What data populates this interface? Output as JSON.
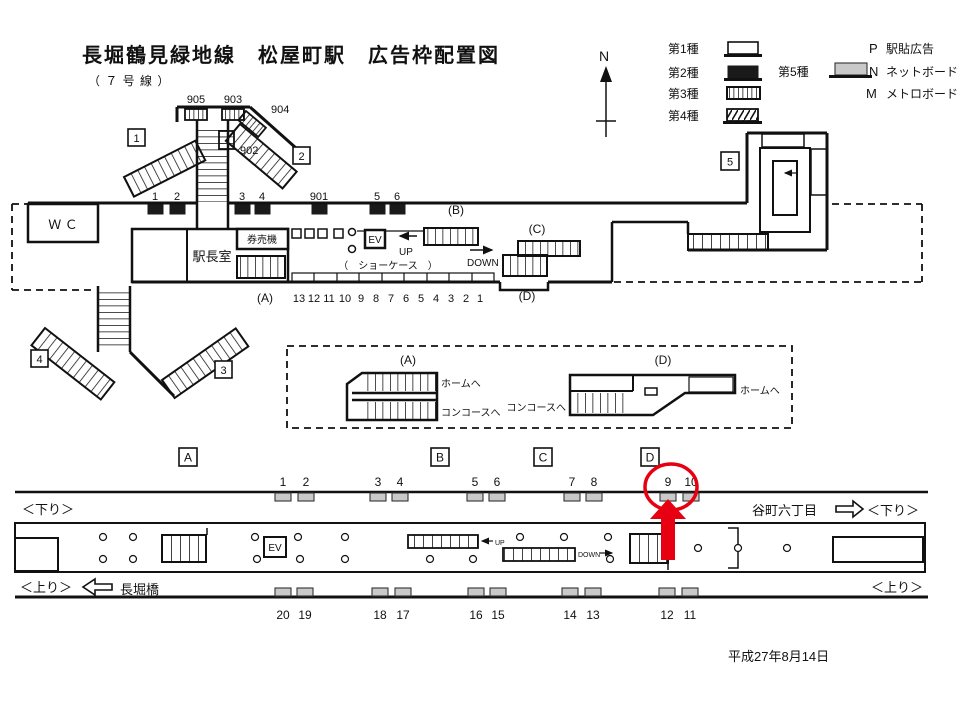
{
  "title": "長堀鶴見緑地線　松屋町駅　広告枠配置図",
  "subtitle": "（ ７ 号 線 ）",
  "date": "平成27年8月14日",
  "compass_label": "N",
  "legend": {
    "type1": "第1種",
    "type2": "第2種",
    "type3": "第3種",
    "type4": "第4種",
    "type5": "第5種",
    "p_key": "P",
    "p_label": "駅貼広告",
    "n_key": "N",
    "n_label": "ネットボード",
    "m_key": "M",
    "m_label": "メトロボード"
  },
  "concourse": {
    "wc": "Ｗ Ｃ",
    "office": "駅長室",
    "ticket_machines": "券売機",
    "showcase": "（　ショーケース　）",
    "ev": "EV",
    "up": "UP",
    "down": "DOWN",
    "exit_numbers": [
      "1",
      "2",
      "3",
      "4",
      "5"
    ],
    "upper_wall_ads": [
      "1",
      "2",
      "3",
      "4",
      "901",
      "5",
      "6"
    ],
    "street_ads": [
      "905",
      "903",
      "904",
      "902"
    ],
    "showcase_numbers": [
      "13",
      "12",
      "11",
      "10",
      "9",
      "8",
      "7",
      "6",
      "5",
      "4",
      "3",
      "2",
      "1"
    ],
    "area_a": "(A)",
    "area_b": "(B)",
    "area_c": "(C)",
    "area_d": "(D)"
  },
  "stair_details": {
    "a_label": "(A)",
    "d_label": "(D)",
    "a_to_platform": "ホームへ",
    "a_to_concourse": "コンコースへ",
    "d_to_platform": "ホームへ",
    "d_to_concourse": "コンコースへ"
  },
  "platform": {
    "section_labels": [
      "A",
      "B",
      "C",
      "D"
    ],
    "top_numbers": [
      "1",
      "2",
      "3",
      "4",
      "5",
      "6",
      "7",
      "8",
      "9",
      "10"
    ],
    "bottom_numbers": [
      "20",
      "19",
      "18",
      "17",
      "16",
      "15",
      "14",
      "13",
      "12",
      "11"
    ],
    "down_label_left": "＜下り＞",
    "down_label_right": "＜下り＞",
    "up_label_left": "＜上り＞",
    "up_label_right": "＜上り＞",
    "station_right": "谷町六丁目",
    "station_left": "長堀橋",
    "ev": "EV",
    "up": "UP",
    "down": "DOWN",
    "highlight_number": "9"
  },
  "colors": {
    "highlight": "#e60012",
    "ad_gray": "#c9c9c9",
    "ad_dark": "#1a1a1a"
  }
}
